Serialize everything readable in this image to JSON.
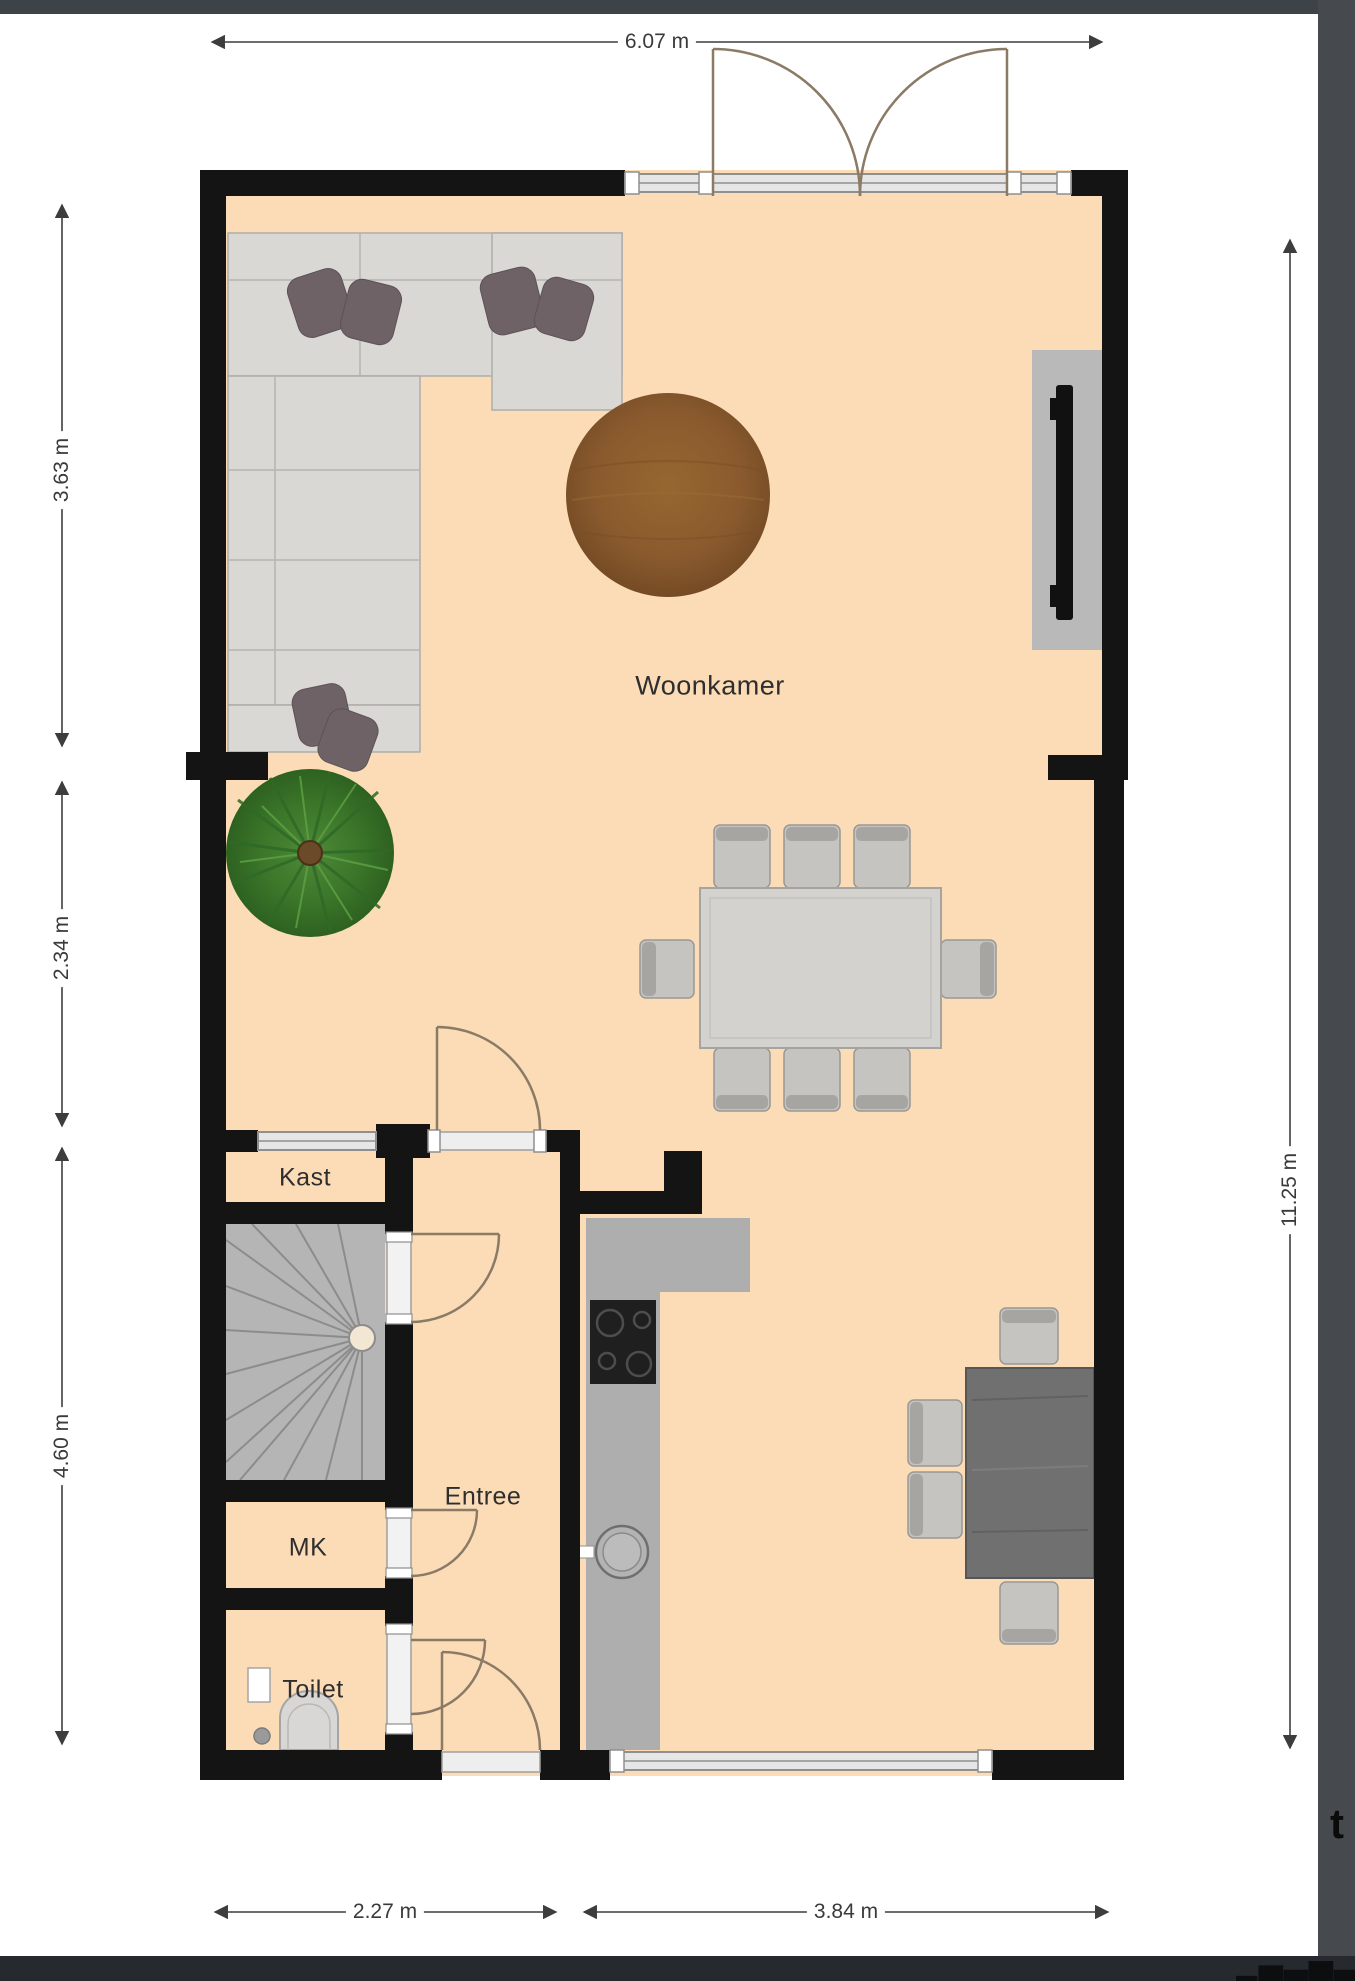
{
  "title": "floor-plan",
  "labels": {
    "woonkamer": "Woonkamer",
    "kast": "Kast",
    "entree": "Entree",
    "mk": "MK",
    "toilet": "Toilet"
  },
  "dimensions": {
    "top": "6.07 m",
    "left_upper": "3.63 m",
    "left_middle": "2.34 m",
    "left_lower": "4.60 m",
    "right": "11.25 m",
    "bottom_left": "2.27 m",
    "bottom_right": "3.84 m"
  },
  "watermark": {
    "right_fragment": "t",
    "bottom_fragment": "▄▆▅▇▅▆▄▅"
  },
  "furniture": [
    "corner-sofa",
    "cushions",
    "round-wood-rug",
    "tv-wall-unit",
    "dining-table",
    "dining-chairs",
    "house-plant",
    "winder-staircase",
    "kitchen-counter",
    "cooktop",
    "kitchen-sink",
    "dark-dining-table",
    "toilet-bowl",
    "small-sink"
  ],
  "colors": {
    "floor": "#fbdcb6",
    "wall": "#141414",
    "window_fill": "#e6e6e6",
    "window_line": "#8f8f8f",
    "door_arc": "#8a7a66",
    "sofa": "#d9d8d5",
    "pillow": "#6f6266",
    "rug_wood": "#8a5a2e",
    "stairs": "#b5b5b5",
    "kitchen_counter": "#aeaeae",
    "stove": "#1f1f1f",
    "dining_table": "#d3d2cf",
    "chair": "#c6c4c1",
    "dark_table": "#707070",
    "dimension": "#3d3d3d",
    "band_top": "#3e4347",
    "band_right": "#46494d",
    "band_bottom": "#26292d"
  }
}
